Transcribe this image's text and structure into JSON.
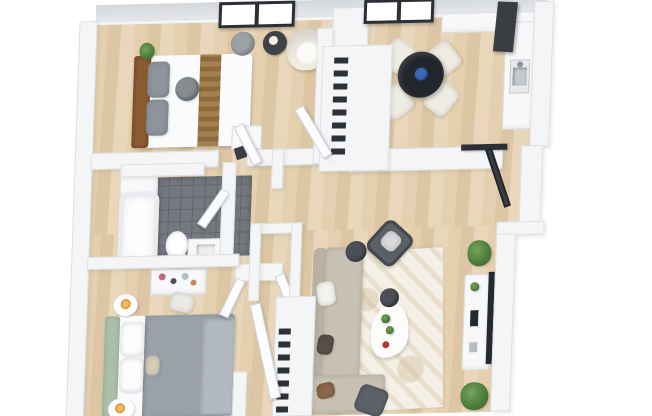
{
  "scene": {
    "description": "3D rendered top-down floor plan of an apartment with two bedrooms, a bathroom, kitchen, dining area, hallway closets and a living room on light wood flooring",
    "background": "#ffffff"
  },
  "palette": {
    "wall": "#f4f5f7",
    "wall_edge": "#dddfe2",
    "wall_face_top": "#d9dcdf",
    "floor_wood": "#dfc9a7",
    "tile": "#74797f",
    "tile_grout": "#61666d",
    "window_frame": "#2c3036",
    "window_glass": "#ffffff",
    "dining_table": "#22262c",
    "centerpiece_blue": "#3a66b8",
    "chair_cream": "#efece2",
    "bed1_headboard": "#8a5a30",
    "bed1_runner": "#9c7a49",
    "pillow_gray": "#8e949b",
    "ottoman_gray": "#878c91",
    "pouf_gray": "#9ca1a6",
    "side_table_dark": "#3e4348",
    "bed2_headboard": "#a9bfab",
    "bed2_duvet": "#9aa1ab",
    "bed2_throw": "#b3b9c1",
    "pillow_tan": "#d8cdb8",
    "sofa": "#c8c1b3",
    "sofa_back": "#b9b2a4",
    "pillow_brown": "#8a684a",
    "pillow_dark": "#575049",
    "chair_dark": "#5c6168",
    "pouf_dark": "#4b5056",
    "tv_dark": "#26292e",
    "appliance_dark": "#3a3d42",
    "plant_green": "#4e7c3b",
    "candle_glow": "#e08a2f",
    "clothes_dark": "#2e3136",
    "rug": "#f4f0e7",
    "bed_white": "#fafbfc",
    "toilet_white": "#ffffff"
  },
  "rooms": [
    {
      "id": "bedroom-1",
      "label": "Bedroom 1"
    },
    {
      "id": "dining-area",
      "label": "Dining Area"
    },
    {
      "id": "kitchen",
      "label": "Kitchen"
    },
    {
      "id": "bathroom",
      "label": "Bathroom"
    },
    {
      "id": "hallway",
      "label": "Hallway"
    },
    {
      "id": "bedroom-2",
      "label": "Bedroom 2"
    },
    {
      "id": "living-room",
      "label": "Living Room"
    },
    {
      "id": "entry",
      "label": "Entry"
    }
  ],
  "windows": [
    {
      "id": "window-1",
      "panes": 2
    },
    {
      "id": "window-2",
      "panes": 2
    }
  ],
  "furniture": {
    "bedroom_1": [
      "double bed with wood headboard",
      "two gray pillows",
      "striped throw runner",
      "round gray ottoman",
      "gray pouf",
      "dark round side table",
      "cream armchair",
      "potted plant",
      "white dresser"
    ],
    "dining_area": [
      "round dark dining table",
      "blue centerpiece",
      "four cream dining chairs"
    ],
    "kitchen": [
      "L-shaped white counter",
      "sink with faucet",
      "tall dark appliance panel",
      "white column cabinet"
    ],
    "bathroom": [
      "bathtub",
      "toilet",
      "vanity sink",
      "washer cabinet",
      "dark tile floor",
      "inward swinging door"
    ],
    "bedroom_2": [
      "double bed with sage headboard",
      "white pillows",
      "gray duvet and throw",
      "two round nightstands with candles",
      "makeup desk with cosmetics",
      "desk chair",
      "open wardrobe with two doors"
    ],
    "hallway": [
      "closet with hanging clothes",
      "second closet with hanging clothes",
      "cased opening",
      "swinging doors"
    ],
    "living_room": [
      "beige sectional sofa with pillows",
      "patterned area rug",
      "organic white coffee table",
      "dark accent chair",
      "dark pouf",
      "dark side chair",
      "white media console",
      "wall mounted tv",
      "two potted plants",
      "dark planter"
    ],
    "entry": [
      "open dark framed glass door"
    ]
  }
}
